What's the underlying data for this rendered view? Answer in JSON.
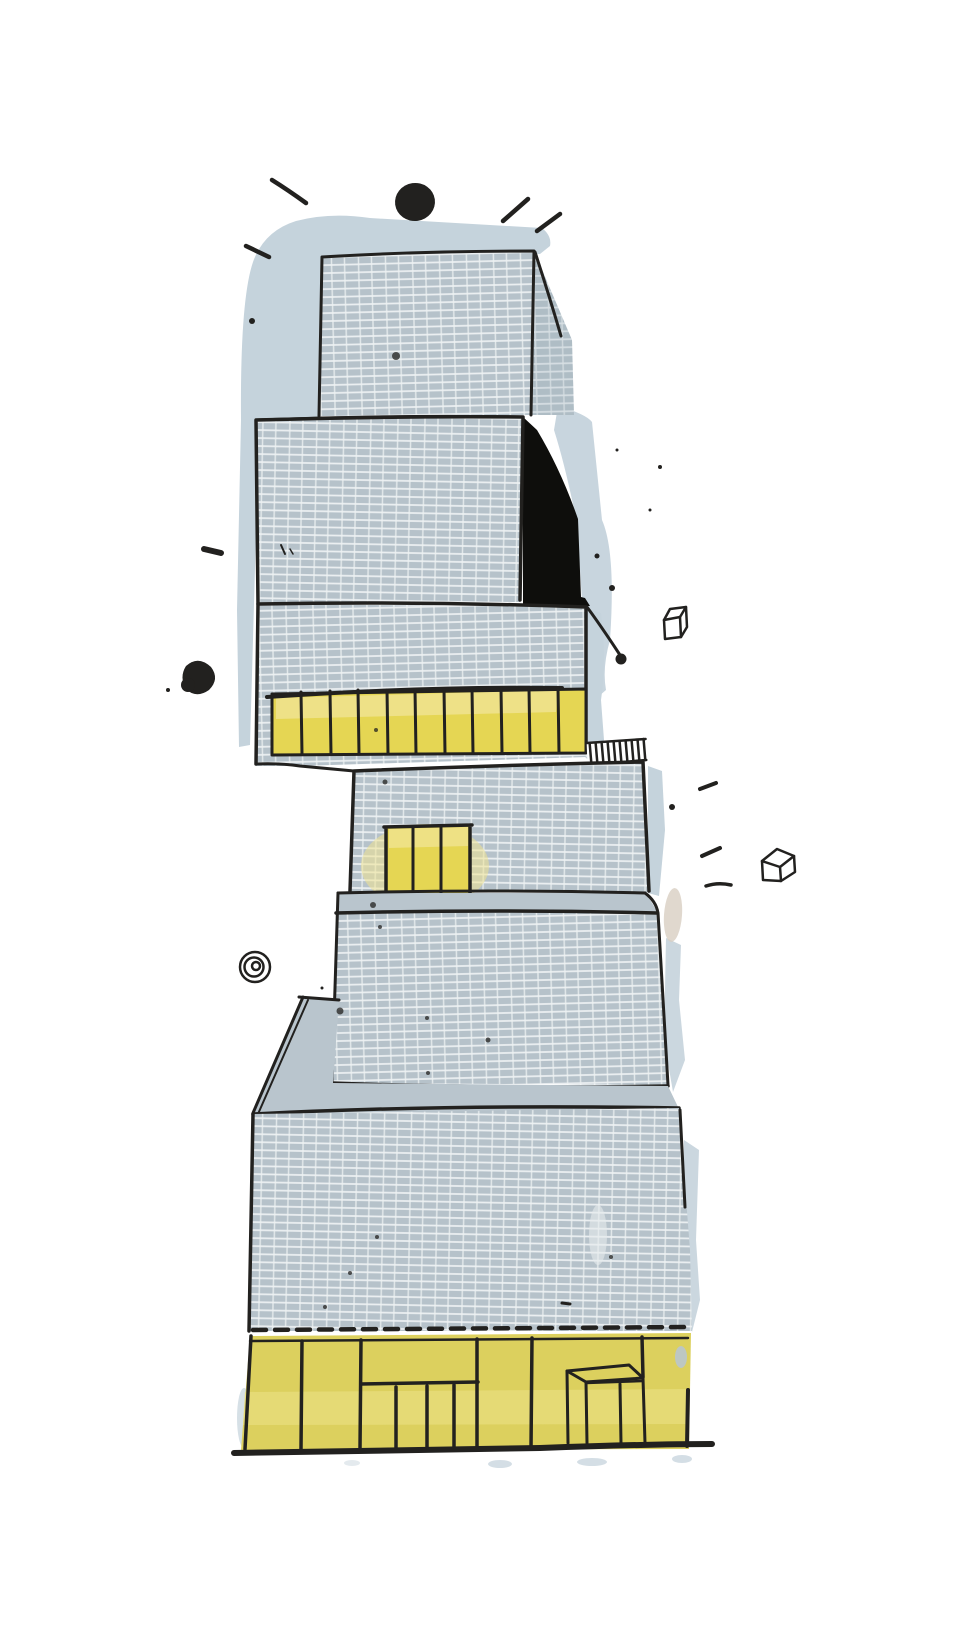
{
  "colors": {
    "paper": "#ffffff",
    "ink": "#22211f",
    "facade": "#b6c2ca",
    "grid_line": "#eef1f3",
    "facade_shade": "#9fb0ba",
    "halo": "#c5d3dc",
    "roof": "#b9c5cd",
    "shadow": "#0e0e0c",
    "yellow": "#e5d653",
    "yellow_light": "#f0e391",
    "storefront": "#dcd05e",
    "storefront_light": "#e8dd7e",
    "tan": "#d8cec2",
    "smudge": "#e6ebec",
    "ground_smudge": "#c9d6de"
  },
  "illustration": {
    "subject": "hand-drawn sketch of a tower of six stacked offset boxes with crosshatched facades",
    "elements": [
      "sun-with-rays",
      "stacked-box-1-top",
      "stacked-box-2-with-black-side",
      "stacked-box-3-with-yellow-window-band",
      "stacked-box-4-with-yellow-rooftop-box",
      "stacked-box-5",
      "stacked-box-6-base",
      "yellow-storefront-band",
      "ground-line",
      "spiral-doodle",
      "ink-blot",
      "cube-doodles",
      "dash-and-speck-doodles"
    ]
  }
}
